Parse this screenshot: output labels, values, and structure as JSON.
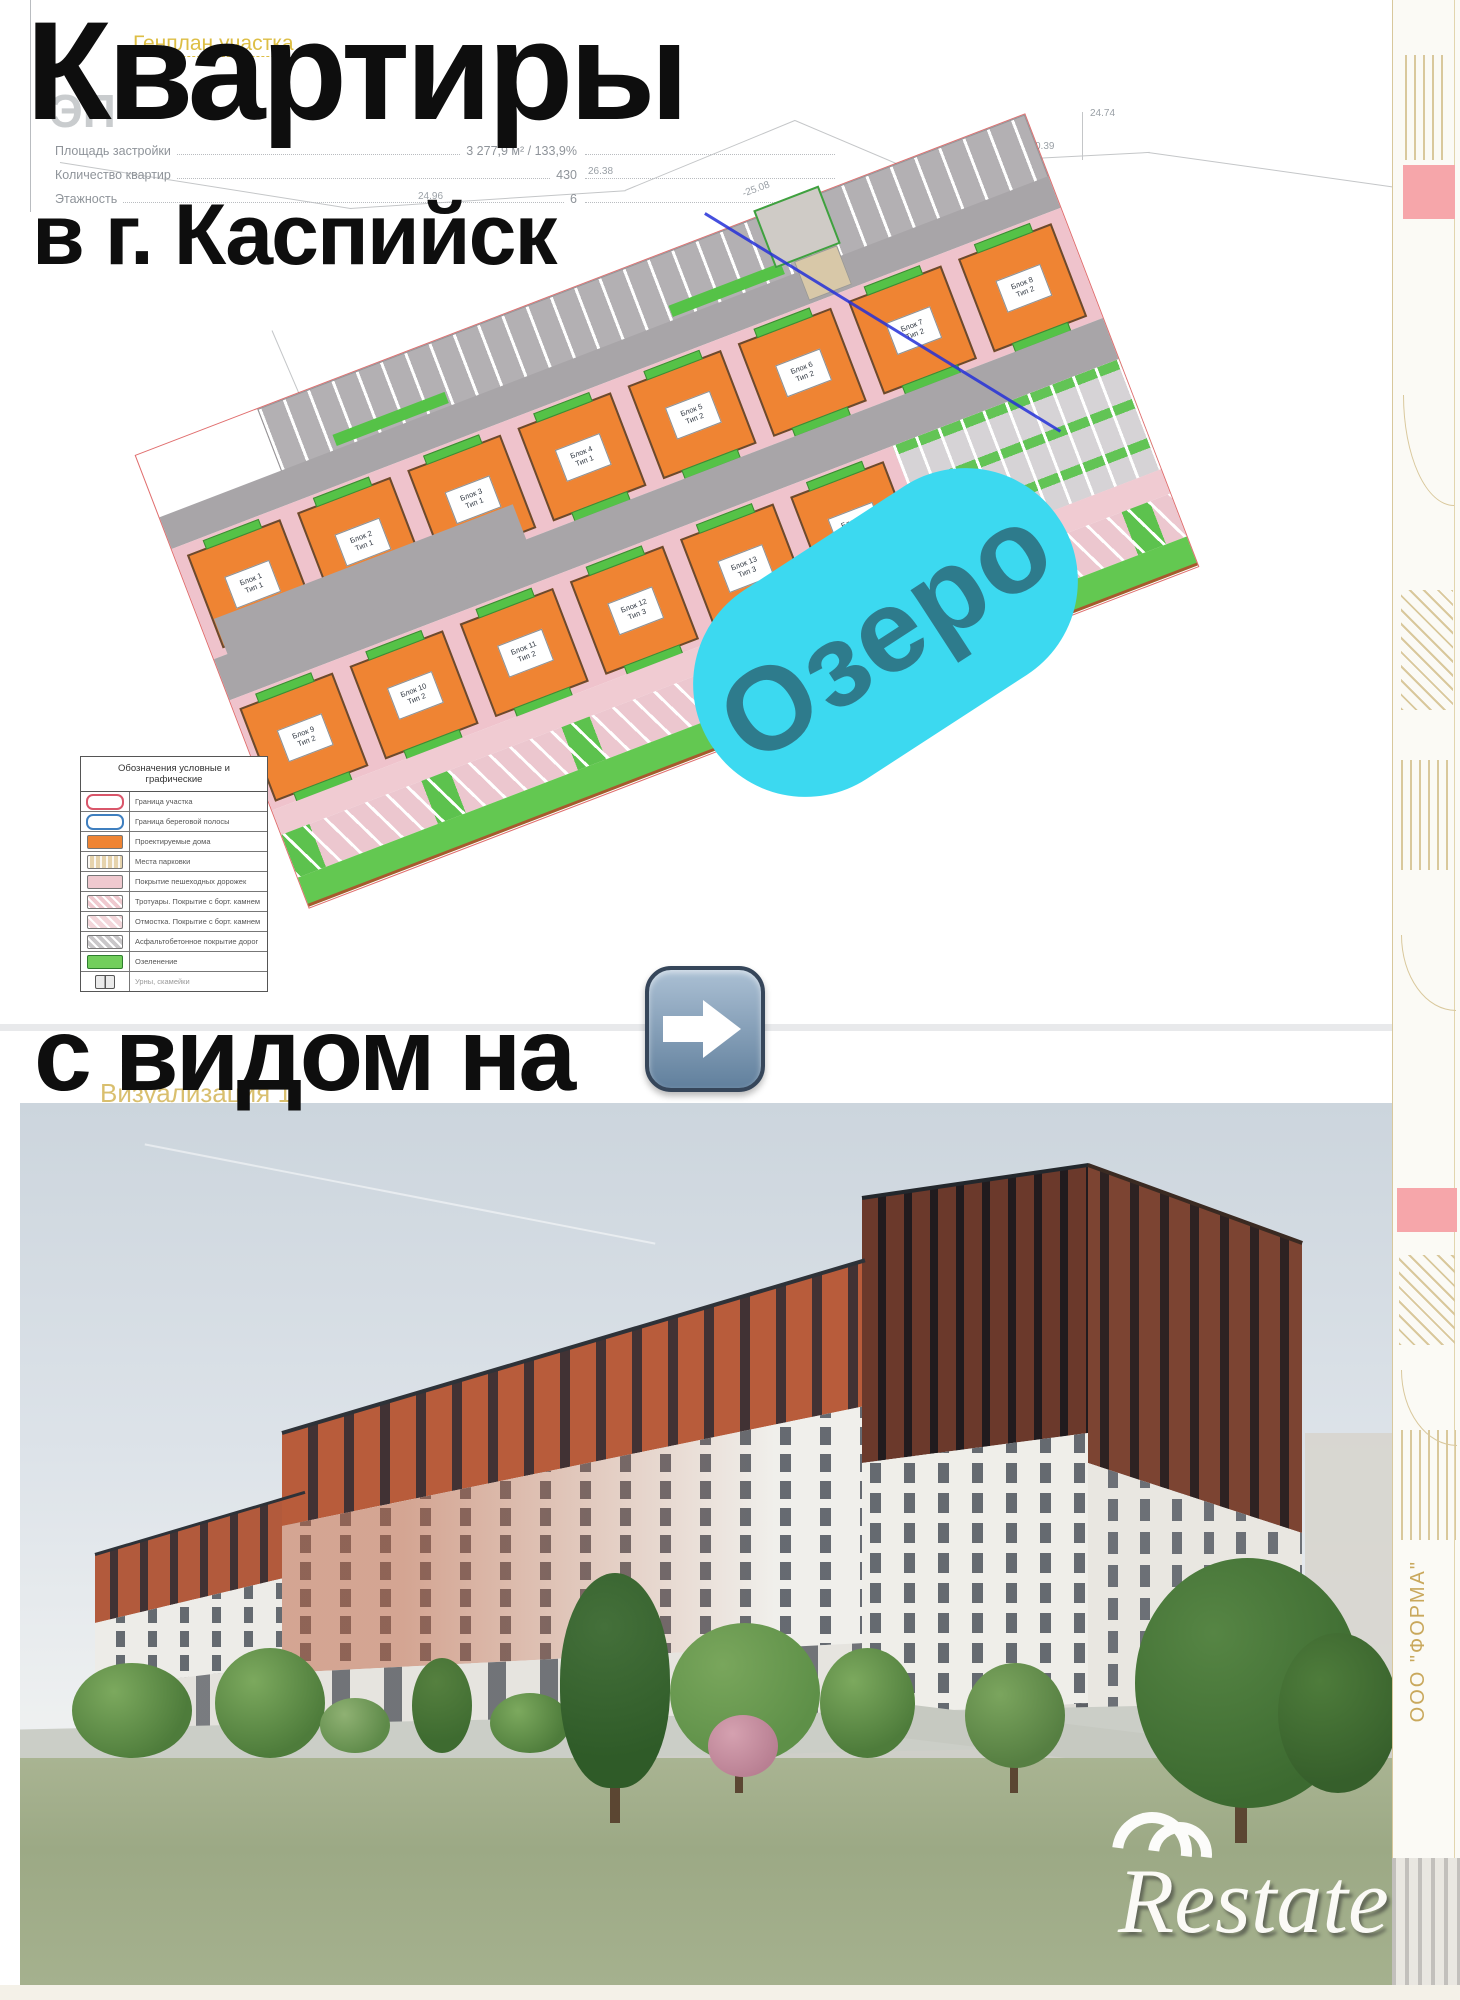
{
  "headline": {
    "line1": "Квартиры",
    "line2": "в г. Каспийск",
    "line3": "с видом на",
    "bubble_label": "Озеро"
  },
  "sheet": {
    "code": "ЭП",
    "title": "Генплан участка",
    "caption": "Визуализация 1",
    "company": "ООО \"ФОРМА\"",
    "stats": [
      {
        "label": "Площадь застройки",
        "value": "3 277,9 м² / 133,9%"
      },
      {
        "label": "Количество квартир",
        "value": "430"
      },
      {
        "label": "Этажность",
        "value": "6"
      }
    ],
    "annotations": [
      "24.96",
      "26.38",
      "-25.08",
      "18.94",
      "24.74",
      "0.39",
      "-0.48",
      "-45.00",
      "20А/ВС",
      "-0.00"
    ]
  },
  "legend": {
    "title": "Обозначения условные и графические",
    "items": [
      {
        "label": "Граница участка"
      },
      {
        "label": "Граница береговой полосы"
      },
      {
        "label": "Проектируемые дома"
      },
      {
        "label": "Места парковки"
      },
      {
        "label": "Покрытие пешеходных дорожек"
      },
      {
        "label": "Тротуары. Покрытие с борт. камнем"
      },
      {
        "label": "Отмостка. Покрытие с борт. камнем"
      },
      {
        "label": "Асфальтобетонное покрытие дорог"
      },
      {
        "label": "Озеленение"
      },
      {
        "label": "Урны, скамейки"
      }
    ]
  },
  "plan": {
    "buildings_top": [
      {
        "name": "Блок 1",
        "type": "Тип 1"
      },
      {
        "name": "Блок 2",
        "type": "Тип 1"
      },
      {
        "name": "Блок 3",
        "type": "Тип 1"
      },
      {
        "name": "Блок 4",
        "type": "Тип 1"
      },
      {
        "name": "Блок 5",
        "type": "Тип 2"
      },
      {
        "name": "Блок 6",
        "type": "Тип 2"
      },
      {
        "name": "Блок 7",
        "type": "Тип 2"
      },
      {
        "name": "Блок 8",
        "type": "Тип 2"
      }
    ],
    "buildings_bottom": [
      {
        "name": "Блок 9",
        "type": "Тип 2"
      },
      {
        "name": "Блок 10",
        "type": "Тип 2"
      },
      {
        "name": "Блок 11",
        "type": "Тип 2"
      },
      {
        "name": "Блок 12",
        "type": "Тип 3"
      },
      {
        "name": "Блок 13",
        "type": "Тип 3"
      },
      {
        "name": "Блок 14",
        "type": "Тип 3"
      }
    ]
  },
  "watermark": {
    "text": "Restate"
  },
  "icons": {
    "arrow": "right-arrow-emoji"
  },
  "colors": {
    "accent_cyan": "#3cd9f0",
    "bubble_text": "#2e7b8c",
    "building_orange": "#ef8433",
    "greenery": "#55c247",
    "pavement_pink": "#efc3cc",
    "road_gray": "#a8a5a8",
    "brick": "#b85c3b",
    "brick_dark": "#6b3a2b",
    "boundary_red": "#d9566a",
    "utility_blue": "#2430d8"
  }
}
